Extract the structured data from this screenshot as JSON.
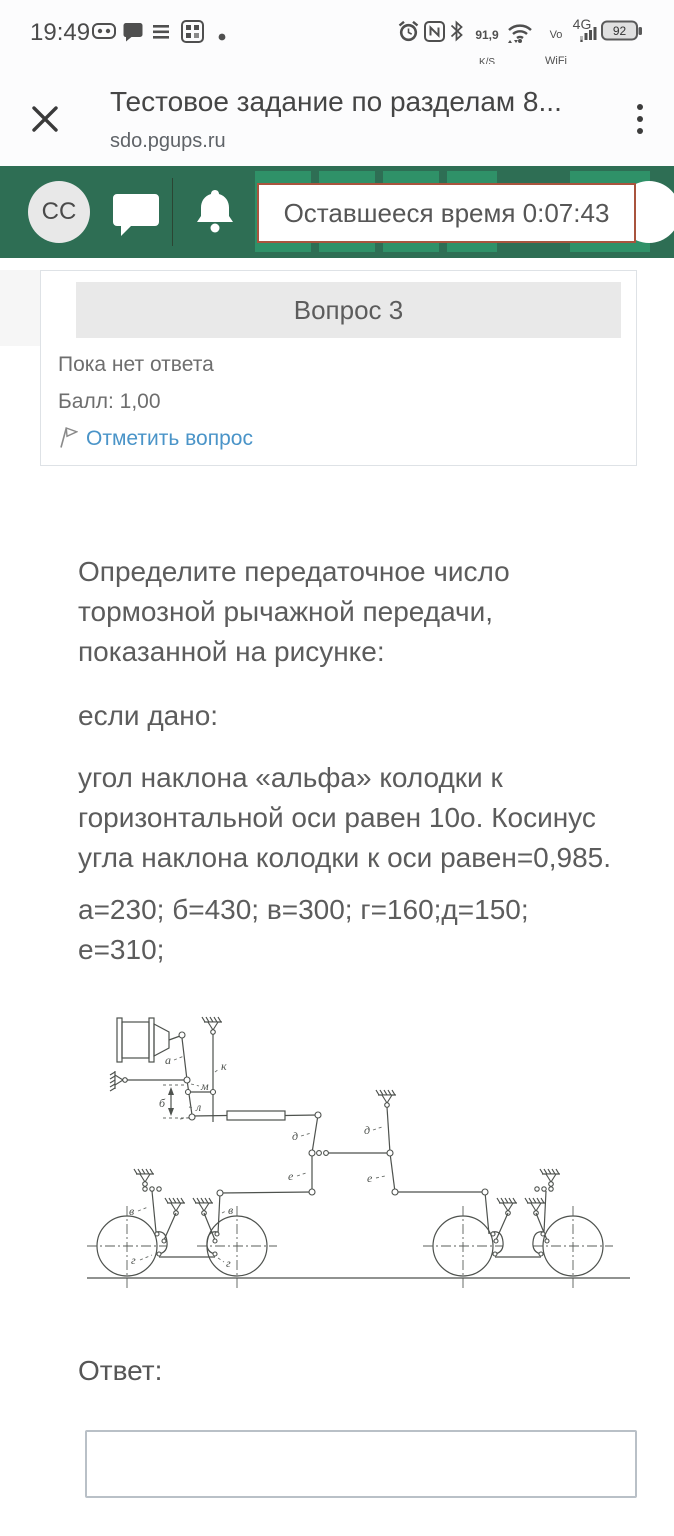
{
  "status_bar": {
    "time": "19:49",
    "net_speed_value": "91,9",
    "net_speed_unit": "K/S",
    "vo_line1": "Vo",
    "vo_line2": "WiFi",
    "network_type": "4G",
    "battery_percent": "92",
    "icons": [
      "controller-icon",
      "chat-bubble-icon",
      "lines-icon",
      "widget-grid-icon",
      "notification-dot",
      "alarm-clock-icon",
      "nfc-icon",
      "bluetooth-icon",
      "wifi-icon",
      "signal-bars-icon",
      "battery-icon"
    ]
  },
  "browser": {
    "page_title": "Тестовое задание по разделам 8...",
    "page_domain": "sdo.pgups.ru"
  },
  "quiz_bar": {
    "avatar_initials": "СС",
    "timer_text": "Оставшееся время 0:07:43"
  },
  "question": {
    "title": "Вопрос 3",
    "status": "Пока нет ответа",
    "grade": "Балл: 1,00",
    "flag_label": "Отметить вопрос",
    "p1": "Определите передаточное число тормозной рычажной передачи, показанной на рисунке:",
    "p2": "если дано:",
    "p3": "угол наклона «альфа» колодки к горизонтальной оси равен 10о. Косинус угла наклона колодки к оси равен=0,985.",
    "p4": "а=230; б=430; в=300; г=160;д=150; е=310;",
    "answer_label": "Ответ:",
    "answer_value": ""
  },
  "diagram": {
    "labels": {
      "a": "а",
      "b": "б",
      "k": "к",
      "m": "м",
      "l": "л",
      "d1": "д",
      "d2": "д",
      "e1": "е",
      "e2": "е",
      "v1": "в",
      "v2": "в",
      "g1": "г",
      "g2": "г"
    }
  },
  "colors": {
    "header_green": "#2e6e54",
    "header_green_light": "#2f9168",
    "timer_border": "#a9543e",
    "link_blue": "#4a94c8"
  }
}
